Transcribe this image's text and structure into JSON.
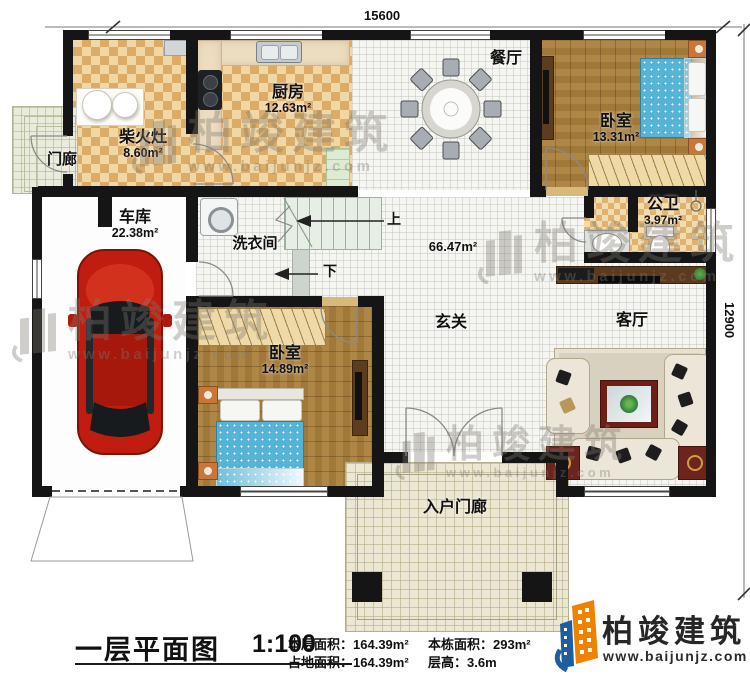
{
  "plan": {
    "dimensions": {
      "top": "15600",
      "right": "12900"
    },
    "rooms": {
      "chaihuozao": {
        "name": "柴火灶",
        "area": "8.60m²"
      },
      "kitchen": {
        "name": "厨房",
        "area": "12.63m²"
      },
      "dining": {
        "name": "餐厅"
      },
      "bedroom1": {
        "name": "卧室",
        "area": "13.31m²"
      },
      "bathroom": {
        "name": "公卫",
        "area": "3.97m²"
      },
      "porch": {
        "name": "门廊"
      },
      "garage": {
        "name": "车库",
        "area": "22.38m²"
      },
      "laundry": {
        "name": "洗衣间"
      },
      "hall": {
        "name": "玄关",
        "area": "66.47m²"
      },
      "living": {
        "name": "客厅"
      },
      "bedroom2": {
        "name": "卧室",
        "area": "14.89m²"
      },
      "entry_porch": {
        "name": "入户门廊"
      }
    },
    "stairs": {
      "up": "上",
      "down": "下"
    }
  },
  "footer": {
    "title": "一层平面图",
    "scale": "1:100",
    "stats": [
      {
        "label": "本层面积：",
        "value": "164.39m²"
      },
      {
        "label": "占地面积：",
        "value": "164.39m²"
      },
      {
        "label": "本栋面积：",
        "value": "293m²"
      },
      {
        "label": "层高：",
        "value": "3.6m"
      }
    ]
  },
  "logo": {
    "name": "柏竣建筑",
    "url": "www.baijunjz.com"
  },
  "watermark": {
    "name": "柏竣建筑",
    "url": "www.baijunjz.com"
  },
  "colors": {
    "wall": "#151515",
    "logo_blue": "#1d5e9e",
    "logo_orange": "#ef8200",
    "car": "#c01d10"
  }
}
